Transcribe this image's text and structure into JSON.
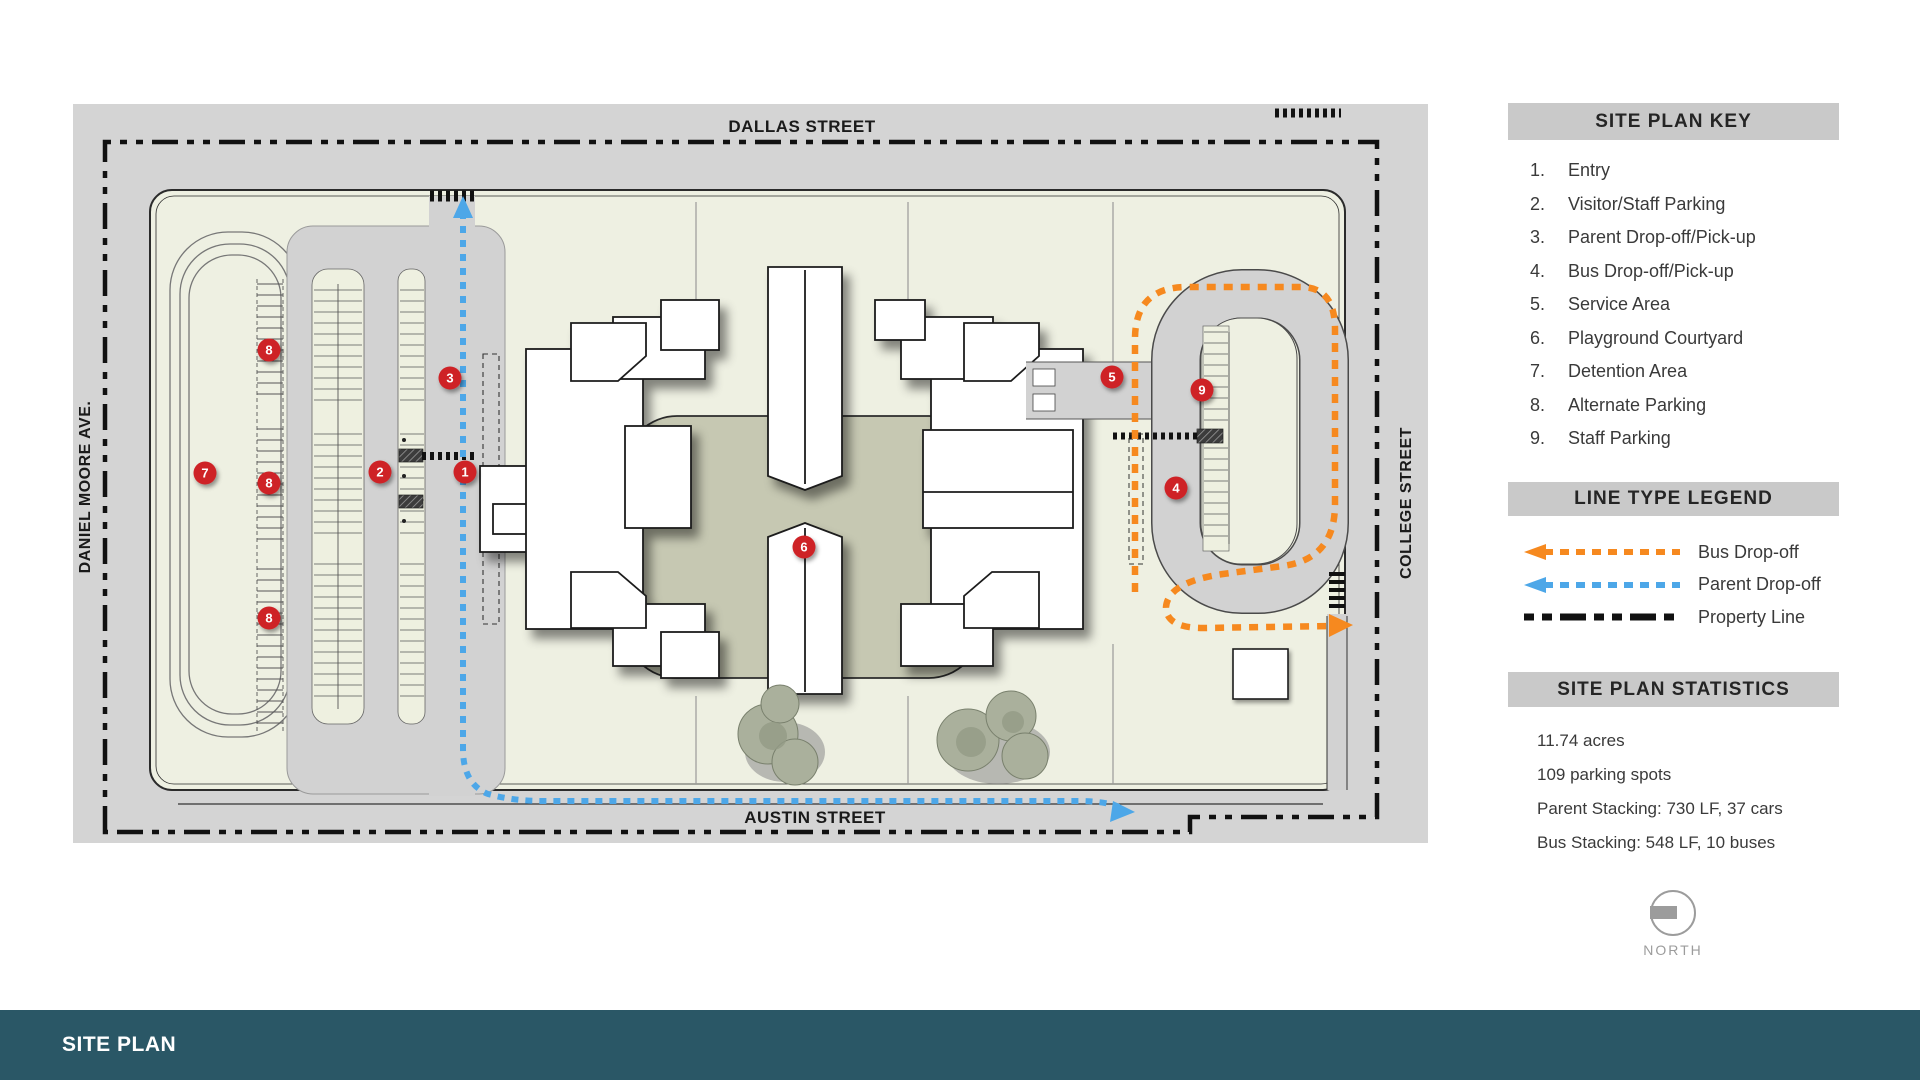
{
  "map": {
    "streets": {
      "top": "DALLAS STREET",
      "bottom": "AUSTIN STREET",
      "left": "DANIEL MOORE AVE.",
      "right": "COLLEGE STREET"
    },
    "markers": [
      {
        "num": "1",
        "x": 392,
        "y": 368
      },
      {
        "num": "2",
        "x": 307,
        "y": 368
      },
      {
        "num": "3",
        "x": 377,
        "y": 274
      },
      {
        "num": "4",
        "x": 1103,
        "y": 384
      },
      {
        "num": "5",
        "x": 1039,
        "y": 273
      },
      {
        "num": "6",
        "x": 731,
        "y": 443
      },
      {
        "num": "7",
        "x": 132,
        "y": 369
      },
      {
        "num": "8",
        "x": 196,
        "y": 246
      },
      {
        "num": "8",
        "x": 196,
        "y": 379
      },
      {
        "num": "8",
        "x": 196,
        "y": 514
      },
      {
        "num": "9",
        "x": 1129,
        "y": 286
      }
    ],
    "colors": {
      "bus_route": "#f6891f",
      "parent_route": "#4da7e8",
      "property_line": "#111111",
      "marker_red": "#ce2026",
      "street_gray": "#d4d4d4",
      "site_green": "#eef0e2",
      "courtyard_olive": "#c6c8b2",
      "lot_gray": "#d2d2d2",
      "island_cream": "#eef0e0"
    }
  },
  "sidebar": {
    "key": {
      "title": "SITE PLAN KEY",
      "items": [
        {
          "num": "1.",
          "label": "Entry"
        },
        {
          "num": "2.",
          "label": "Visitor/Staff Parking"
        },
        {
          "num": "3.",
          "label": "Parent Drop-off/Pick-up"
        },
        {
          "num": "4.",
          "label": "Bus Drop-off/Pick-up"
        },
        {
          "num": "5.",
          "label": "Service Area"
        },
        {
          "num": "6.",
          "label": "Playground Courtyard"
        },
        {
          "num": "7.",
          "label": "Detention Area"
        },
        {
          "num": "8.",
          "label": "Alternate Parking"
        },
        {
          "num": "9.",
          "label": "Staff Parking"
        }
      ]
    },
    "legend": {
      "title": "LINE TYPE LEGEND",
      "items": [
        {
          "label": "Bus Drop-off",
          "color": "#f6891f",
          "arrow": true
        },
        {
          "label": "Parent Drop-off",
          "color": "#4da7e8",
          "arrow": true
        },
        {
          "label": "Property Line",
          "color": "#111111",
          "arrow": false
        }
      ]
    },
    "stats": {
      "title": "SITE PLAN STATISTICS",
      "lines": [
        "11.74 acres",
        "109 parking spots",
        "Parent Stacking: 730 LF, 37 cars",
        "Bus Stacking: 548 LF, 10 buses"
      ]
    },
    "north_label": "NORTH"
  },
  "footer": {
    "title": "SITE PLAN",
    "color": "#2a5766"
  }
}
